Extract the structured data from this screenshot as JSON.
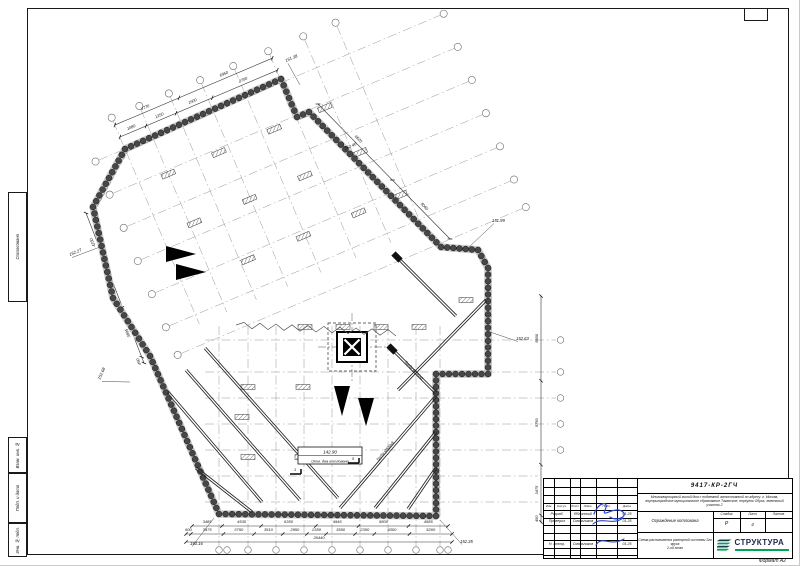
{
  "sheet": {
    "format_label": "Формат А2"
  },
  "side_stamp": {
    "items": [
      "Согласовано",
      "Взам. инв. №",
      "Подп. и дата",
      "Инв. № подл."
    ]
  },
  "title_block": {
    "doc_code": "9417-КР-2ГЧ",
    "project": "Многоквартирный жилой дом с подземной автостоянкой по адресу: г. Москва, внутригородское муниципальное образование Таганское, переулок Обуха, земельный участок 2",
    "object": "Ограждение котлована",
    "drawing_title_1": "Схема расположения распорной системы 2го яруса",
    "drawing_title_2": "2-ой этап",
    "columns": [
      "Изм.",
      "Кол.уч.",
      "Лист",
      "№док.",
      "Подп.",
      "Дата"
    ],
    "rows": [
      {
        "role": "Разраб.",
        "name": "Яблонский",
        "date": "01.25"
      },
      {
        "role": "Проверил",
        "name": "Смольников",
        "date": "01.25"
      },
      {
        "role": "Н. контр.",
        "name": "Смольников",
        "date": "01.25"
      }
    ],
    "stage_label": "Стадия",
    "sheet_label": "Лист",
    "sheets_label": "Листов",
    "stage": "Р",
    "sheet_no": "4",
    "sheets_total": "",
    "logo_text": "СТРУКТУРА"
  },
  "plan": {
    "pit_bottom": {
      "elevation": "142.90",
      "caption": "Отм. дна котлована"
    },
    "elevations": [
      "152.27",
      "151.38",
      "152.46",
      "151.99",
      "152.63",
      "152.68",
      "150.16",
      "152.35"
    ],
    "strut_label": "Труба Ø530х8",
    "section_marks": [
      "1",
      "5"
    ],
    "dims": {
      "top_near": [
        "1080",
        "1250",
        "1500",
        "2700"
      ],
      "top_far": [
        "4770",
        "6950"
      ],
      "top_right": [
        "6520",
        "5060"
      ],
      "left": [
        "4250",
        "2845",
        "3895",
        "450"
      ],
      "right": [
        "5800",
        "5750",
        "3475",
        "450"
      ],
      "bottom_row1": [
        "3485",
        "4535",
        "6350",
        "4945",
        "5800",
        "4585"
      ],
      "bottom_row2": [
        "600",
        "3975",
        "3750",
        "3510",
        "2950",
        "2350",
        "3550",
        "2350",
        "4300",
        "5200"
      ],
      "bottom_total": [
        "26440"
      ]
    }
  }
}
